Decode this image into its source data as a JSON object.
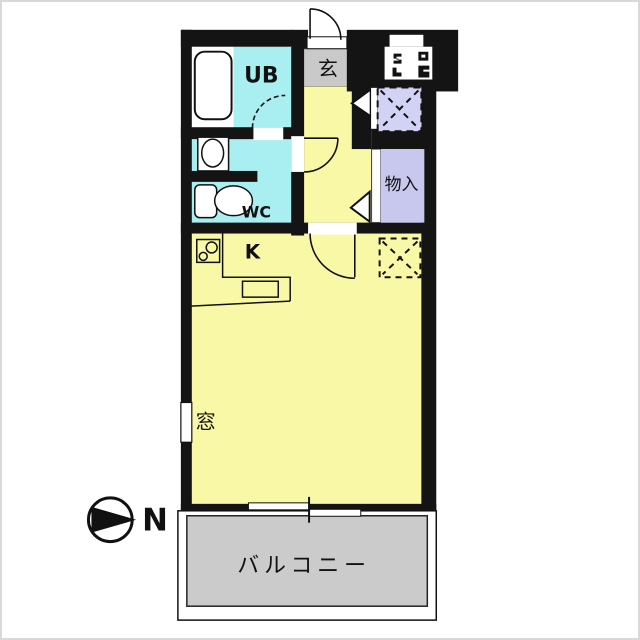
{
  "title": "apartment-floorplan",
  "labels": {
    "unit_bath": "UB",
    "entrance": "玄",
    "wc": "WC",
    "storage": "物入",
    "kitchen": "K",
    "window": "窓",
    "balcony": "バルコニー",
    "north": "N"
  },
  "colors": {
    "wall": "#141414",
    "water_rooms": "#a9eef0",
    "living": "#f8f8a6",
    "entrance_floor": "#c9c9c9",
    "storage_fill": "#c8c8ee",
    "pipe_space_fill": "#d2d2f4",
    "balcony_floor": "#cbcbcb",
    "shoe_cabinet": "#d9c189",
    "white": "#ffffff",
    "line": "#111111"
  },
  "icons": {
    "bathtub": "bathtub-icon",
    "washbasin": "washbasin-icon",
    "toilet": "toilet-icon",
    "stove": "stove-icon",
    "sink": "sink-icon",
    "entrance_door": "door-swing-arc",
    "pipe_space": "dashed-x-box",
    "refrigerator_space": "dashed-x-box",
    "meter_box": "meter-box-marks",
    "compass": "compass-north-icon",
    "sliding_door": "sliding-door-icon"
  }
}
